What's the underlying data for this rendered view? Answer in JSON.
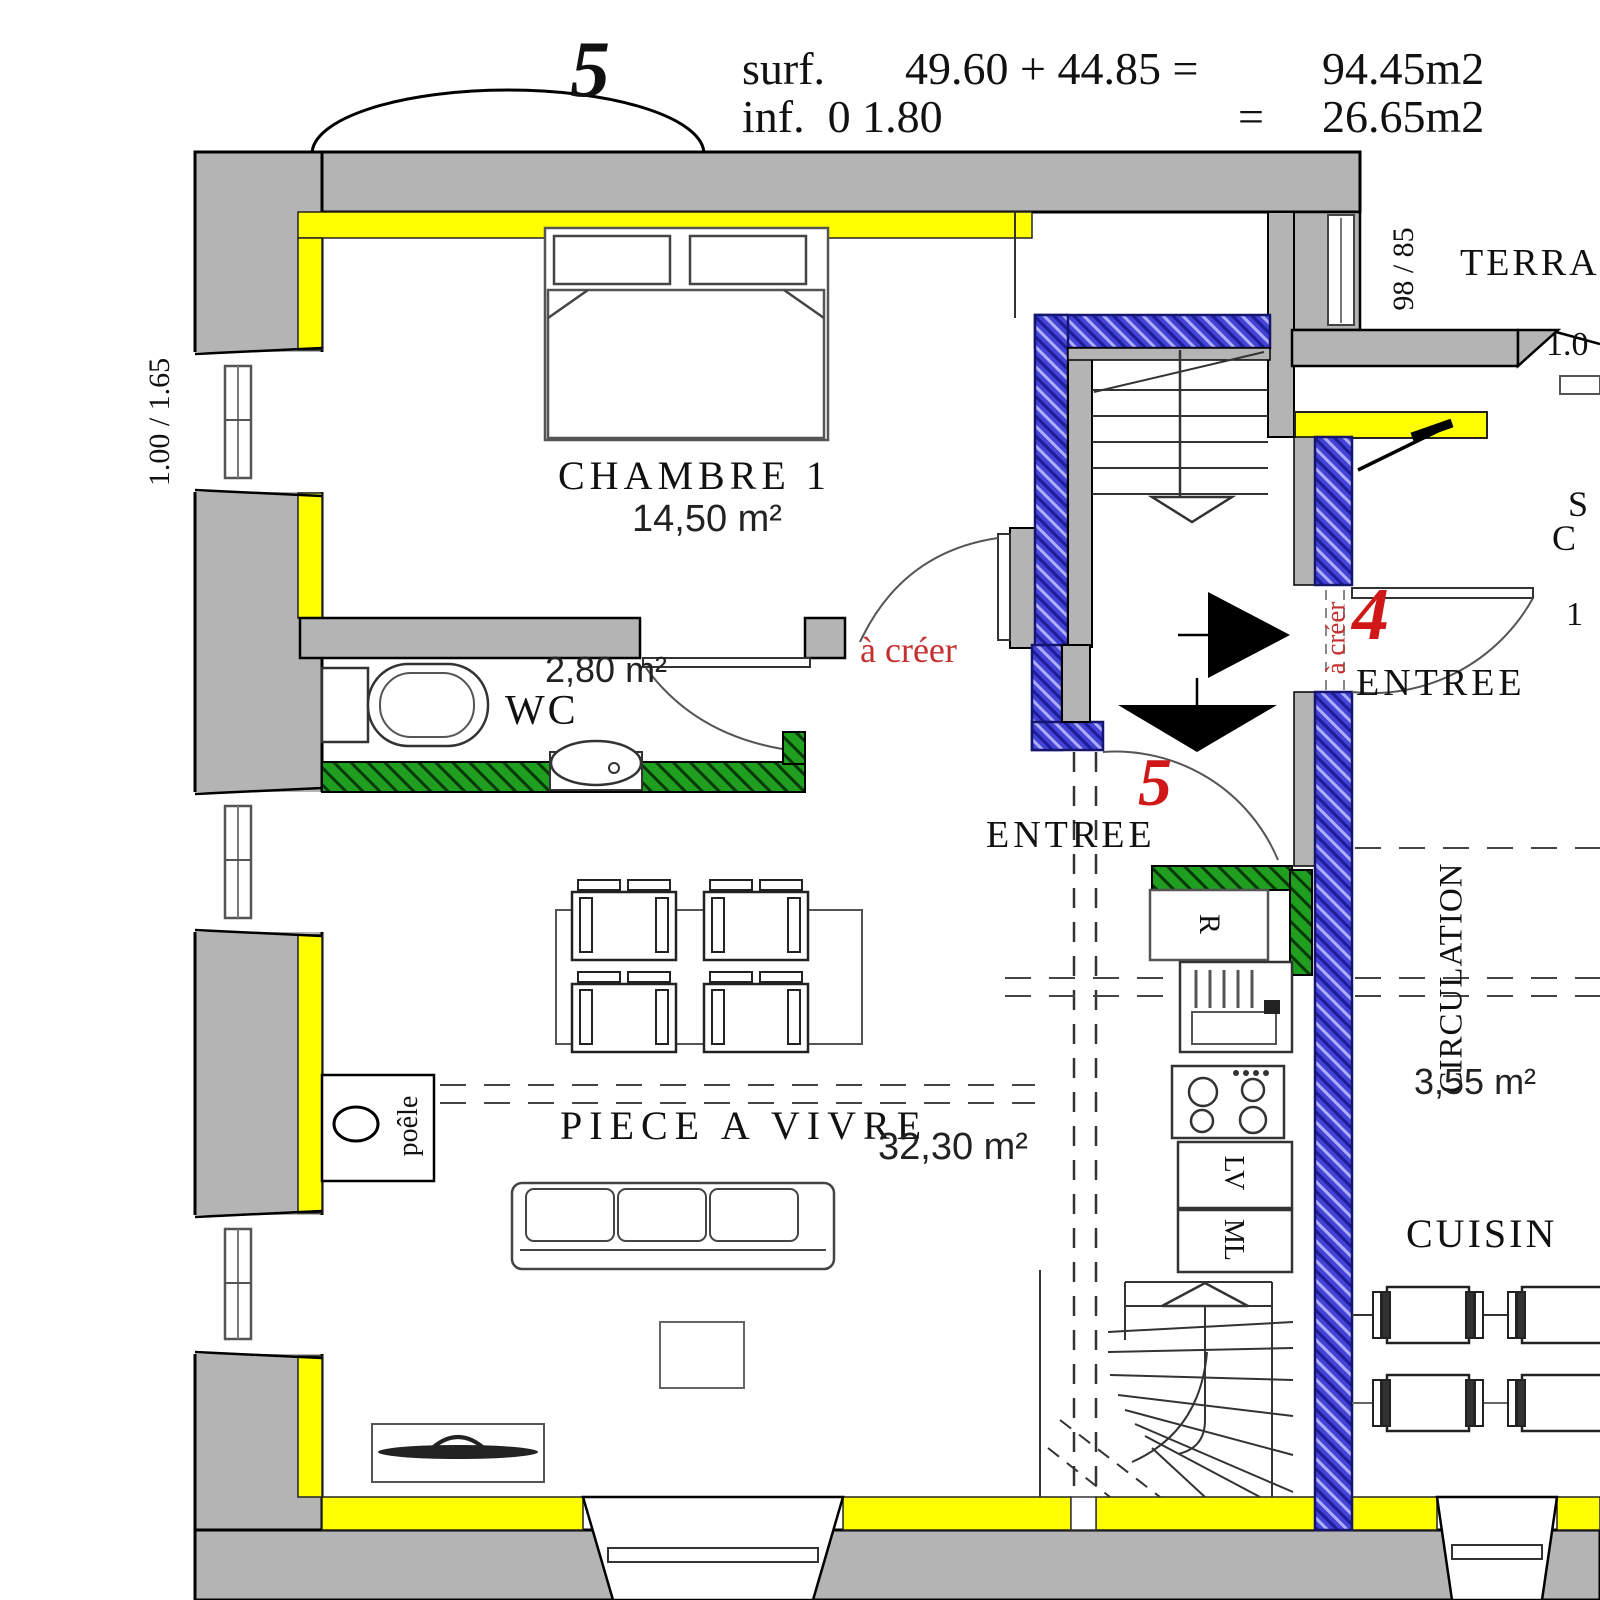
{
  "header": {
    "unit_number": "5",
    "surf_label": "surf.",
    "surf_expr": "49.60 + 44.85 =",
    "surf_total": "94.45m2",
    "inf_label": "inf.  0 1.80",
    "equals": "=",
    "inf_total": "26.65m2"
  },
  "rooms": {
    "chambre1": {
      "name": "CHAMBRE 1",
      "area": "14,50 m²"
    },
    "wc": {
      "name": "WC",
      "area": "2,80 m²"
    },
    "piece_a_vivre": {
      "name": "PIECE  A  VIVRE",
      "area": "32,30 m²"
    },
    "circulation": {
      "name": "CIRCULATION",
      "area": "3,55 m²"
    },
    "cuisine": {
      "name": "CUISIN"
    },
    "terrasse": {
      "name": "TERRA"
    }
  },
  "entrances": {
    "unit5": {
      "label": "ENTREE",
      "number": "5"
    },
    "unit4": {
      "label": "ENTREE",
      "number": "4"
    }
  },
  "annotations": {
    "a_creer_door": "à créer",
    "a_creer_wall": "à créer"
  },
  "dimensions": {
    "left_window": "1.00 / 1.65",
    "terrace_window": "98 / 85",
    "terrace_dim": "1.0"
  },
  "appliances": {
    "fridge": "R",
    "dishwasher": "LV",
    "washer": "ML",
    "stove": "poêle"
  },
  "fragments": {
    "right_s": "S",
    "right_c": "C",
    "right_one": "1"
  },
  "colors": {
    "wall_gray": "#b4b4b4",
    "insulation_yellow": "#ffff00",
    "new_wall_blue": "#4343d6",
    "green_wall": "#1f9e1f",
    "annotation_red": "#c43030",
    "number_red": "#d01818"
  }
}
